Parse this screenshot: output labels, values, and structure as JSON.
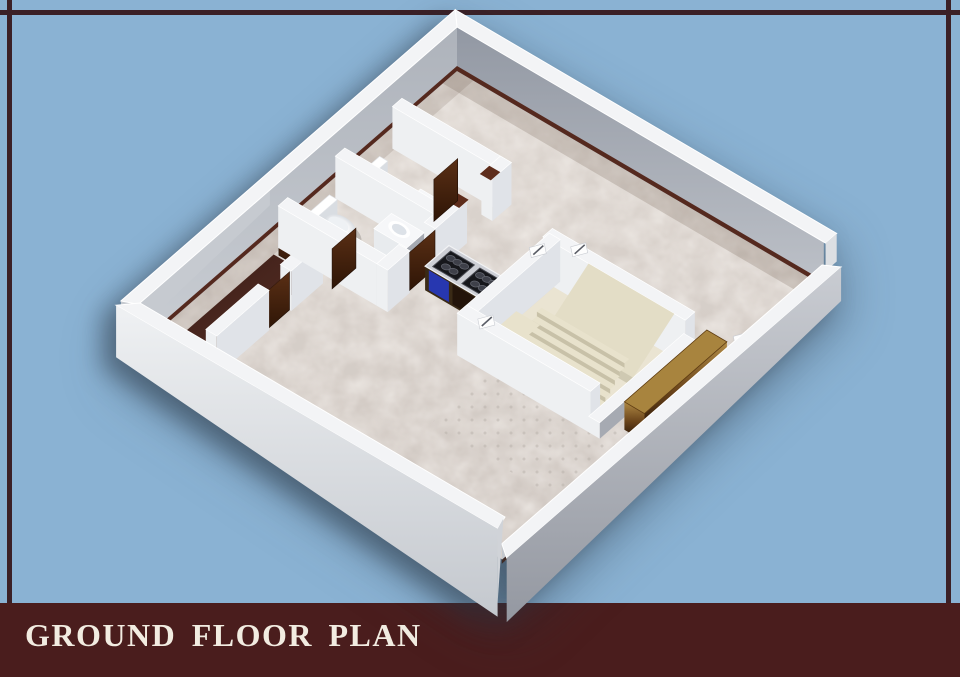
{
  "backdrop": {
    "background_color": "#8ab2d3",
    "frame_line_color": "#3b2026"
  },
  "footer": {
    "title": "GROUND FLOOR PLAN",
    "bar_color": "#4a1d1d",
    "title_color": "#f2ece1"
  },
  "scene": {
    "name": "3d-ground-floor-plan-render",
    "elements": [
      "marble-floor",
      "outer-walls",
      "dark-floor-corridor",
      "bathroom-toilets",
      "wash-basins",
      "wooden-doors",
      "kitchen-counter-hobs",
      "staircase",
      "entrance-door",
      "vent-marks"
    ],
    "colors": {
      "floorTop": "#ddd6d0",
      "floorBottom": "#cfc7c1",
      "floorMottle": "#f6efe9",
      "dotColor": "#b4ada6",
      "wallTop": "#f3f4f6",
      "faceBright": "#eef0f2",
      "faceLight": "#e0e3e8",
      "faceMid": "#a6aab2",
      "faceDark": "#959aa4",
      "neFaceTop": "#9298a3",
      "neFaceBottom": "#bdc1c8",
      "nwFaceTop": "#aeb3bb",
      "nwFaceBottom": "#c9cdd3",
      "seOuterTop": "#c9ccd2",
      "seOuterBottom": "#9498a1",
      "swOuterTop": "#eff1f3",
      "swOuterBottom": "#c4c8ce",
      "baseboard": "#55291e",
      "doorFrame": "#5e2d1c",
      "corridorDark": "#3a1b14",
      "corridorLight": "#5a332a",
      "doorLight": "#5a2f15",
      "doorDarkC": "#2e1506",
      "porcelain": "#ffffff",
      "porcShade": "#d9dde2",
      "counterTop": "#cdcfd5",
      "hob": "#16171b",
      "burner": "#3e4049",
      "cabinetBlue": "#2737b0",
      "cabinetBrown": "#23140a",
      "cabinetBase": "#3a2a16",
      "stairFloor": "#eae4d2",
      "stairTread": "#e8e2cc",
      "stairFace": "#c8c1a8",
      "stairMass": "#e3ddc6",
      "stairMassFace": "#cfc9b2",
      "goldTop": "#b08a44",
      "goldMid": "#69431a",
      "goldDark": "#190b02",
      "goldLid": "#a8843e"
    }
  }
}
